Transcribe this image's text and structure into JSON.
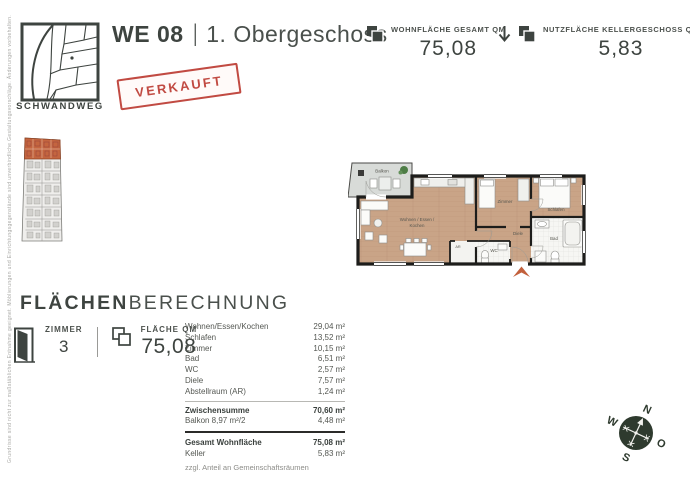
{
  "brand": "SCHWANDWEG",
  "header": {
    "unit": "WE 08",
    "divider": "|",
    "floor": "1. Obergeschoss",
    "stamp": "VERKAUFT"
  },
  "stats": {
    "living": {
      "label": "WOHNFLÄCHE GESAMT QM",
      "value": "75,08"
    },
    "cellar": {
      "label": "NUTZFLÄCHE KELLERGESCHOSS QM",
      "value": "5,83"
    }
  },
  "side_note": "Grundrisse sind nicht zur maßstäblichen Entnahme geeignet. Möblierungen und Einrichtungsgegenstände sind unverbindliche Gestaltungsvorschläge. Änderungen vorbehalten.",
  "floorplan": {
    "labels": {
      "balkon": "Balkon",
      "wohnen_line1": "Wohnen / Essen /",
      "wohnen_line2": "Kochen",
      "zimmer": "Zimmer",
      "schlafen": "Schlafen",
      "diele": "Diele",
      "bad": "Bad",
      "wc": "WC",
      "ar": "AR"
    }
  },
  "berechnung": {
    "heading_bold": "FLÄCHEN",
    "heading_light": "BERECHNUNG",
    "zimmer_label": "ZIMMER",
    "zimmer_value": "3",
    "flaeche_label": "FLÄCHE QM",
    "flaeche_value": "75,08",
    "table": {
      "rows": [
        {
          "label": "Wohnen/Essen/Kochen",
          "value": "29,04 m²"
        },
        {
          "label": "Schlafen",
          "value": "13,52 m²"
        },
        {
          "label": "Zimmer",
          "value": "10,15 m²"
        },
        {
          "label": "Bad",
          "value": "6,51 m²"
        },
        {
          "label": "WC",
          "value": "2,57 m²"
        },
        {
          "label": "Diele",
          "value": "7,57 m²"
        },
        {
          "label": "Abstellraum (AR)",
          "value": "1,24 m²"
        }
      ],
      "subtotal_rows": [
        {
          "label": "Zwischensumme",
          "value": "70,60 m²"
        },
        {
          "label": "Balkon 8,97 m²/2",
          "value": "4,48 m²"
        }
      ],
      "total_rows": [
        {
          "label": "Gesamt Wohnfläche",
          "value": "75,08 m²"
        },
        {
          "label": "Keller",
          "value": "5,83 m²"
        }
      ],
      "footnote": "zzgl. Anteil an Gemeinschaftsräumen"
    }
  },
  "compass": {
    "north": "N",
    "west": "W",
    "east": "O",
    "south": "S"
  },
  "colors": {
    "ink": "#3e4440",
    "stamp_red": "#c14a42",
    "accent_orange": "#c2603c",
    "wood_floor": "#c9a487",
    "wall_black": "#1d1d1b",
    "compass_green": "#2e3a2e"
  }
}
